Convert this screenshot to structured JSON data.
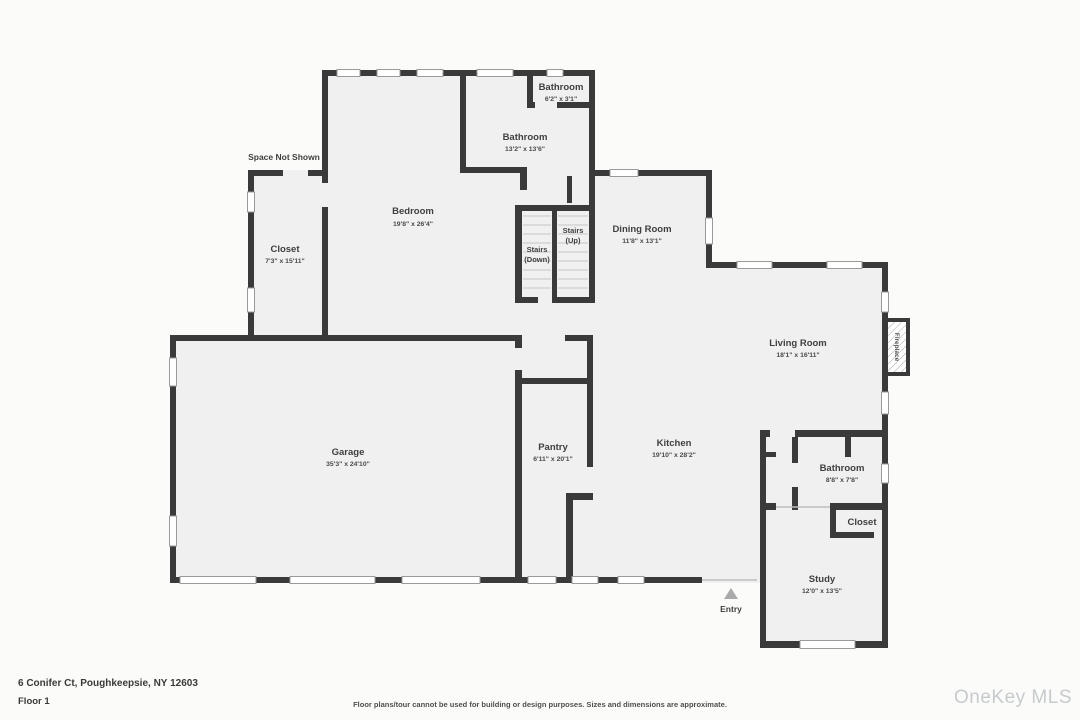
{
  "colors": {
    "canvas": "#fbfbfa",
    "room_fill": "#f0f0f0",
    "wall": "#3a3a3a",
    "window_stroke": "#9a9a9a",
    "label": "#3f3f3f",
    "tread": "#c6c6c6",
    "open_line": "#bdbdbd",
    "entry_arrow": "#a9a9a9",
    "watermark": "#c7cacd"
  },
  "rooms": {
    "bathroom_small": {
      "name": "Bathroom",
      "dims": "6'2\" x 3'1\""
    },
    "bathroom_main": {
      "name": "Bathroom",
      "dims": "13'2\" x 13'6\""
    },
    "bedroom": {
      "name": "Bedroom",
      "dims": "19'8\" x 26'4\""
    },
    "closet_left": {
      "name": "Closet",
      "dims": "7'3\" x 15'11\""
    },
    "dining_room": {
      "name": "Dining Room",
      "dims": "11'8\" x 13'1\""
    },
    "living_room": {
      "name": "Living Room",
      "dims": "18'1\" x 16'11\""
    },
    "garage": {
      "name": "Garage",
      "dims": "35'3\" x 24'10\""
    },
    "pantry": {
      "name": "Pantry",
      "dims": "6'11\" x 20'1\""
    },
    "kitchen": {
      "name": "Kitchen",
      "dims": "19'10\" x 28'2\""
    },
    "bathroom_back": {
      "name": "Bathroom",
      "dims": "8'8\" x 7'8\""
    },
    "closet_study": {
      "name": "Closet"
    },
    "study": {
      "name": "Study",
      "dims": "12'0\" x 13'5\""
    }
  },
  "annotations": {
    "space_not_shown": "Space Not Shown",
    "stairs_down_line1": "Stairs",
    "stairs_down_line2": "(Down)",
    "stairs_up_line1": "Stairs",
    "stairs_up_line2": "(Up)",
    "fireplace": "Fireplace",
    "entry": "Entry"
  },
  "footer": {
    "address": "6 Conifer Ct, Poughkeepsie, NY 12603",
    "floor": "Floor 1",
    "disclaimer": "Floor plans/tour cannot be used for building or design purposes. Sizes and dimensions are approximate.",
    "watermark": "OneKey MLS"
  }
}
